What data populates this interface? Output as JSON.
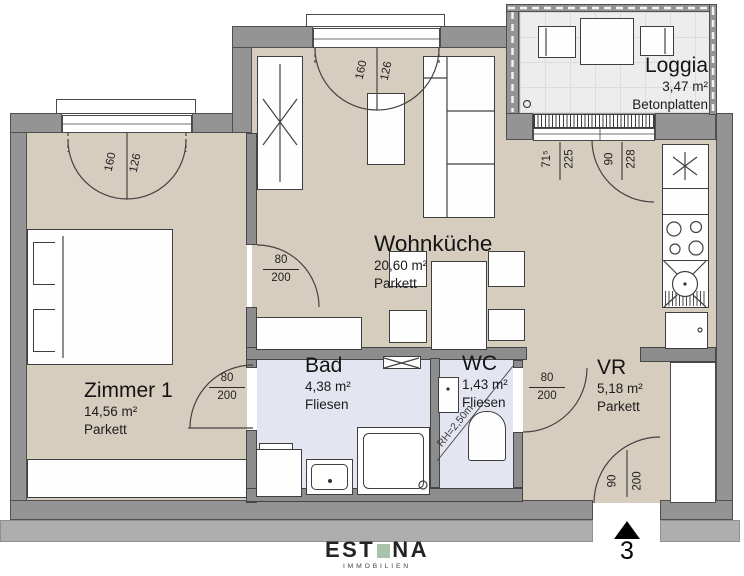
{
  "rooms": {
    "zimmer1": {
      "name": "Zimmer 1",
      "area": "14,56 m²",
      "floor": "Parkett"
    },
    "wohnkueche": {
      "name": "Wohnküche",
      "area": "20,60 m²",
      "floor": "Parkett"
    },
    "bad": {
      "name": "Bad",
      "area": "4,38 m²",
      "floor": "Fliesen"
    },
    "wc": {
      "name": "WC",
      "area": "1,43 m²",
      "floor": "Fliesen",
      "ceiling_note": "RH=2,50m"
    },
    "vr": {
      "name": "VR",
      "area": "5,18 m²",
      "floor": "Parkett"
    },
    "loggia": {
      "name": "Loggia",
      "area": "3,47 m²",
      "floor": "Betonplatten"
    }
  },
  "openings": {
    "zimmer1_window": {
      "w": "160",
      "h": "126"
    },
    "wohnkueche_window": {
      "w": "160",
      "h": "126"
    },
    "loggia_door": {
      "w": "71⁵",
      "h": "225"
    },
    "loggia_window": {
      "w": "90",
      "h": "228"
    },
    "door_zimmer1_wohnkueche": {
      "w": "80",
      "h": "200"
    },
    "door_zimmer1_bad": {
      "w": "80",
      "h": "200"
    },
    "door_wc": {
      "w": "80",
      "h": "200"
    },
    "entrance_door": {
      "w": "90",
      "h": "200"
    }
  },
  "entrance": {
    "unit_number": "3"
  },
  "branding": {
    "logo_left": "EST",
    "logo_right": "NA",
    "logo_sub": "IMMOBILIEN",
    "logo_square_color": "#a9c3ab"
  },
  "colors": {
    "floor_parkett": "#d7cdbf",
    "floor_fliesen": "#e3e6f0",
    "floor_loggia": "#ededed",
    "wall": "#949494",
    "wall_line": "#4f4f4f"
  }
}
